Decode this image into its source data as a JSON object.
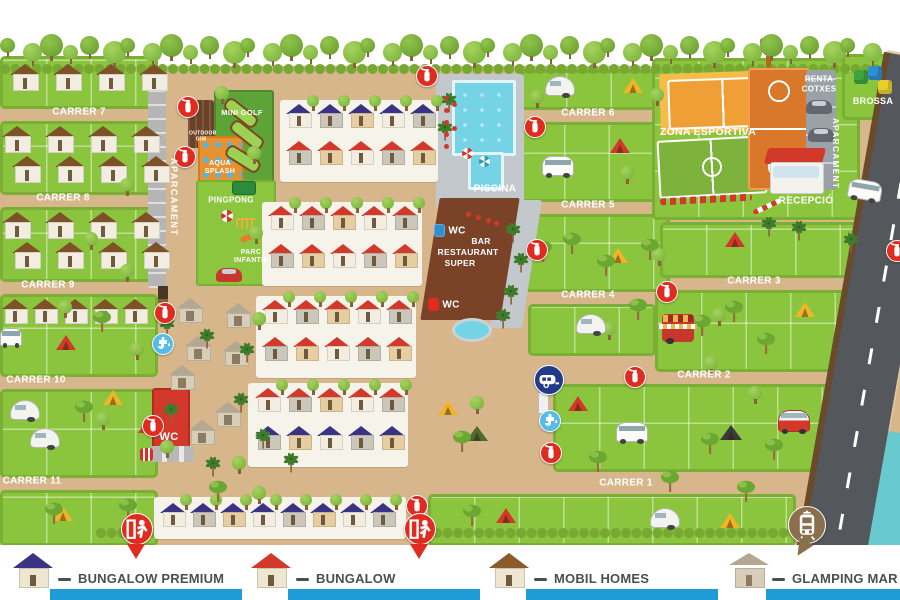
{
  "streets": [
    {
      "label": "CARRER 1"
    },
    {
      "label": "CARRER 2"
    },
    {
      "label": "CARRER 3"
    },
    {
      "label": "CARRER 4"
    },
    {
      "label": "CARRER 5"
    },
    {
      "label": "CARRER 6"
    },
    {
      "label": "CARRER 7"
    },
    {
      "label": "CARRER 8"
    },
    {
      "label": "CARRER 9"
    },
    {
      "label": "CARRER 10"
    },
    {
      "label": "CARRER 11"
    }
  ],
  "zones": {
    "mini_golf": "MINI GOLF",
    "aqua_splash": "AQUA SPLASH",
    "pingpong": "PINGPONG",
    "parc_infantil": "PARC INFANTIL",
    "outdoor_gim": "OUTDOOR GIM",
    "aparcament": "APARCAMENT",
    "piscina": "PISCINA",
    "bar_line1": "BAR",
    "bar_line2": "RESTAURANT",
    "bar_line3": "SUPER",
    "wc": "WC",
    "zona_esportiva": "ZONA ESPORTIVA",
    "recepcio": "RECEPCIÓ",
    "renta_line1": "RENTA",
    "renta_line2": "COTXES",
    "brossa": "BROSSA"
  },
  "legend": {
    "bar_color": "#1f9cd7",
    "items": [
      {
        "label": "BUNGALOW PREMIUM",
        "roof_color": "#3a3383"
      },
      {
        "label": "BUNGALOW",
        "roof_color": "#d2392b"
      },
      {
        "label": "MOBIL HOMES",
        "roof_color": "#8a5a2b"
      },
      {
        "label": "GLAMPING MAR",
        "roof_color": "#b4a893"
      }
    ]
  },
  "icons": [
    {
      "name": "fire-extinguisher-icon",
      "color": "#e02b20"
    },
    {
      "name": "water-tap-icon",
      "color": "#56bde8"
    },
    {
      "name": "motorhome-service-icon",
      "color": "#233a8c"
    },
    {
      "name": "emergency-exit-icon",
      "color": "#e02b20"
    },
    {
      "name": "bus-stop-icon",
      "color": "#8a6f4d"
    }
  ],
  "colors": {
    "ground": "#d7b68b",
    "parcel_green": "#8bc53e",
    "hedge_green": "#76a832",
    "road": "#54585c",
    "sea": "#68cace",
    "sand": "#e0c99f",
    "pool": "#74d4e6",
    "restaurant": "#7a4227",
    "bungalow_premium_roof": "#3a3383",
    "bungalow_roof": "#d2392b",
    "mobil_home_roof": "#7d5226",
    "glamping_roof": "#b4a893"
  }
}
